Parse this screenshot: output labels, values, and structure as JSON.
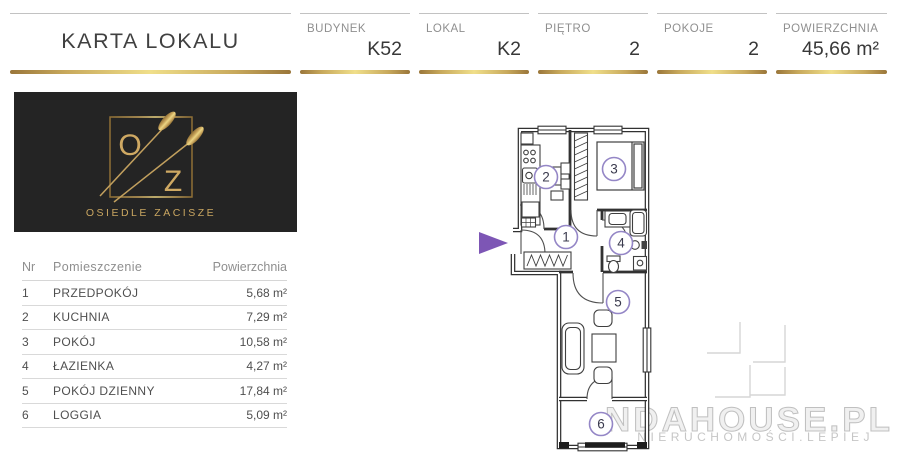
{
  "header": {
    "title": "KARTA LOKALU"
  },
  "info_bar": {
    "cells": [
      {
        "label": "BUDYNEK",
        "value": "K52"
      },
      {
        "label": "LOKAL",
        "value": "K2"
      },
      {
        "label": "PIĘTRO",
        "value": "2"
      },
      {
        "label": "POKOJE",
        "value": "2"
      },
      {
        "label": "POWIERZCHNIA",
        "value": "45,66 m²"
      }
    ]
  },
  "logo": {
    "monogram_top": "O",
    "monogram_bottom": "Z",
    "estate_name": "OSIEDLE ZACISZE"
  },
  "rooms_table": {
    "columns": {
      "nr": "Nr",
      "name": "Pomieszczenie",
      "area": "Powierzchnia"
    },
    "rows": [
      {
        "nr": "1",
        "name": "PRZEDPOKÓJ",
        "area": "5,68 m²"
      },
      {
        "nr": "2",
        "name": "KUCHNIA",
        "area": "7,29 m²"
      },
      {
        "nr": "3",
        "name": "POKÓJ",
        "area": "10,58 m²"
      },
      {
        "nr": "4",
        "name": "ŁAZIENKA",
        "area": "4,27 m²"
      },
      {
        "nr": "5",
        "name": "POKÓJ DZIENNY",
        "area": "17,84 m²"
      },
      {
        "nr": "6",
        "name": "LOGGIA",
        "area": "5,09 m²"
      }
    ]
  },
  "floor_plan": {
    "room_labels": [
      "1",
      "2",
      "3",
      "4",
      "5",
      "6"
    ],
    "entrance_arrow_color": "#7d56b5",
    "room_circle_color": "#9486c6"
  },
  "watermark": {
    "main": "NDAHOUSE.PL",
    "sub": "NIERUCHOMOŚCI.LEPIEJ"
  },
  "colors": {
    "gold_dark": "#9a763a",
    "gold_light": "#f0df8a",
    "text_dark": "#3d3d3d",
    "label_gray": "#8f8f8f",
    "logo_gold": "#c9a661",
    "watermark_gray": "#c6c6c6"
  }
}
